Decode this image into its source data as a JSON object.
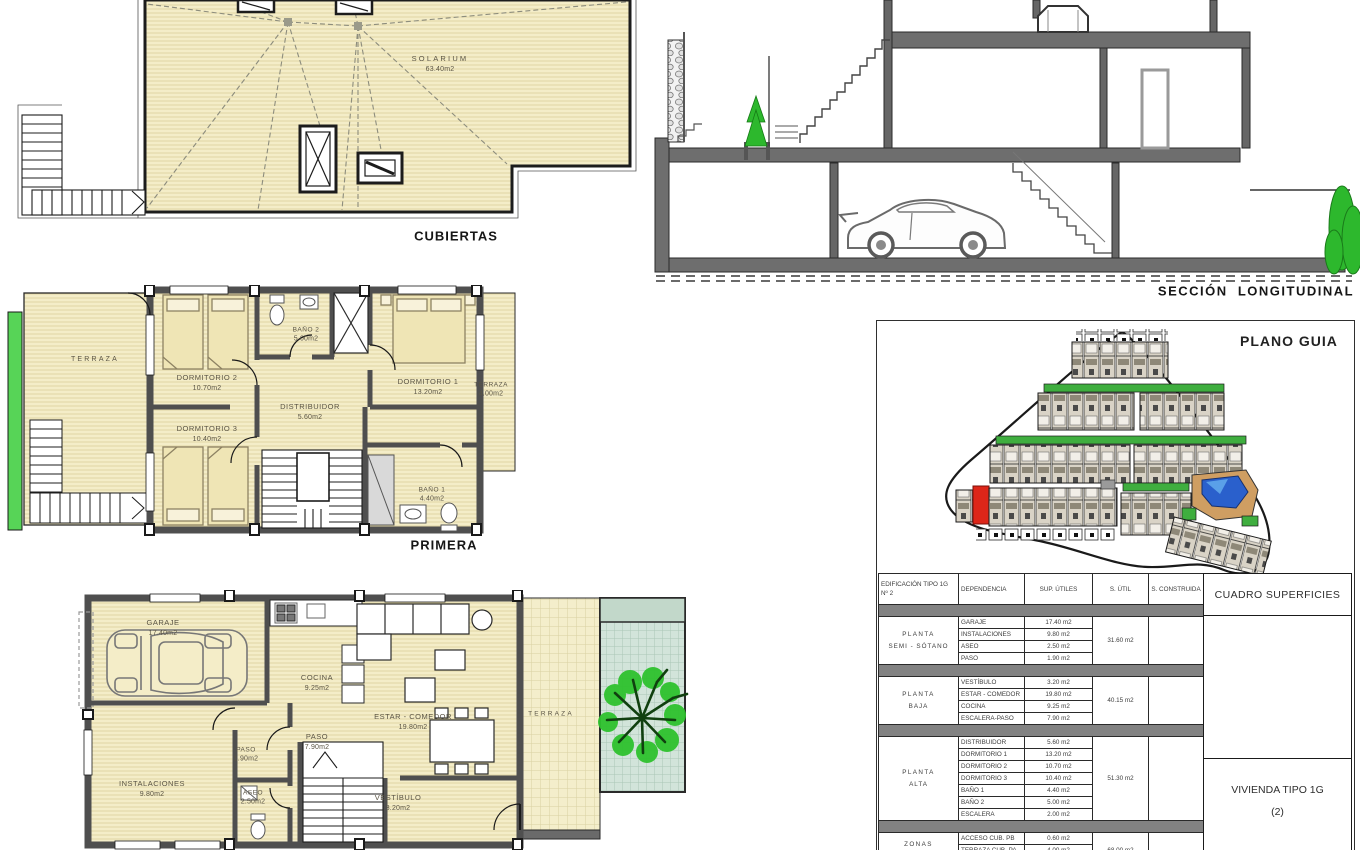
{
  "titles": {
    "cubiertas": "CUBIERTAS",
    "primera": "PRIMERA",
    "seccion": "SECCIÓN  LONGITUDINAL",
    "plano_guia": "PLANO GUIA"
  },
  "roof_plan": {
    "solarium": {
      "name": "SOLARIUM",
      "area": "63.40m2"
    }
  },
  "first_floor": {
    "rooms": [
      {
        "name": "TERRAZA",
        "area": ""
      },
      {
        "name": "DORMITORIO 2",
        "area": "10.70m2"
      },
      {
        "name": "DORMITORIO 3",
        "area": "10.40m2"
      },
      {
        "name": "BAÑO 2",
        "area": "5.00m2"
      },
      {
        "name": "DISTRIBUIDOR",
        "area": "5.60m2"
      },
      {
        "name": "DORMITORIO 1",
        "area": "13.20m2"
      },
      {
        "name": "TERRAZA",
        "area": "4.00m2"
      },
      {
        "name": "BAÑO 1",
        "area": "4.40m2"
      }
    ]
  },
  "ground_floor": {
    "rooms": [
      {
        "name": "GARAJE",
        "area": "17.40m2"
      },
      {
        "name": "INSTALACIONES",
        "area": "9.80m2"
      },
      {
        "name": "PASO",
        "area": "1.90m2"
      },
      {
        "name": "ASEO",
        "area": "2.50m2"
      },
      {
        "name": "COCINA",
        "area": "9.25m2"
      },
      {
        "name": "PASO",
        "area": "7.90m2"
      },
      {
        "name": "ESTAR - COMEDOR",
        "area": "19.80m2"
      },
      {
        "name": "VESTÍBULO",
        "area": "3.20m2"
      },
      {
        "name": "TERRAZA",
        "area": ""
      }
    ]
  },
  "surface_table": {
    "corner": {
      "line1": "EDIFICACIÓN TIPO 1G",
      "line2": "Nº 2"
    },
    "headers": {
      "dependencia": "DEPENDENCIA",
      "sup_utiles": "SUP. ÚTILES",
      "s_util": "S. ÚTIL",
      "s_construida": "S. CONSTRUIDA"
    },
    "right_title": "CUADRO SUPERFICIES",
    "groups": [
      {
        "label1": "PLANTA",
        "label2": "SEMI - SÓTANO",
        "total": "31.60 m2",
        "rows": [
          {
            "name": "GARAJE",
            "value": "17.40 m2"
          },
          {
            "name": "INSTALACIONES",
            "value": "9.80 m2"
          },
          {
            "name": "ASEO",
            "value": "2.50 m2"
          },
          {
            "name": "PASO",
            "value": "1.90 m2"
          }
        ]
      },
      {
        "label1": "PLANTA",
        "label2": "BAJA",
        "total": "40.15 m2",
        "rows": [
          {
            "name": "VESTÍBULO",
            "value": "3.20 m2"
          },
          {
            "name": "ESTAR - COMEDOR",
            "value": "19.80 m2"
          },
          {
            "name": "COCINA",
            "value": "9.25 m2"
          },
          {
            "name": "ESCALERA-PASO",
            "value": "7.90 m2"
          }
        ]
      },
      {
        "label1": "PLANTA",
        "label2": "ALTA",
        "total": "51.30 m2",
        "rows": [
          {
            "name": "DISTRIBUIDOR",
            "value": "5.60 m2"
          },
          {
            "name": "DORMITORIO 1",
            "value": "13.20 m2"
          },
          {
            "name": "DORMITORIO 2",
            "value": "10.70 m2"
          },
          {
            "name": "DORMITORIO 3",
            "value": "10.40 m2"
          },
          {
            "name": "BAÑO 1",
            "value": "4.40 m2"
          },
          {
            "name": "BAÑO 2",
            "value": "5.00 m2"
          },
          {
            "name": "ESCALERA",
            "value": "2.00 m2"
          }
        ]
      },
      {
        "label1": "ZONAS",
        "label2": "EXTERIORES",
        "total": "68.00 m2",
        "rows": [
          {
            "name": "ACCESO CUB.  PB",
            "value": "0.60 m2"
          },
          {
            "name": "TERRAZA CUB.  PA",
            "value": "4.00 m2"
          },
          {
            "name": "SOLARIUM-ESCAL.",
            "value": "63.40 m2"
          }
        ]
      }
    ],
    "dwelling": {
      "line1": "VIVIENDA TIPO 1G",
      "line2": "(2)"
    }
  },
  "colors": {
    "room_fill": "#f4edc8",
    "hatch": "#e0d5a5",
    "wall": "#4f4f4f",
    "slab": "#6e6e6e",
    "green_strip": "#57d457",
    "courtyard": "#d2e4da",
    "tree": "#2ec22e",
    "site_green": "#3fae3f",
    "unit_red": "#dd2619",
    "pool": "#2a60cc",
    "pool_light": "#5aa0e8",
    "pool_deck": "#cf9e62"
  }
}
